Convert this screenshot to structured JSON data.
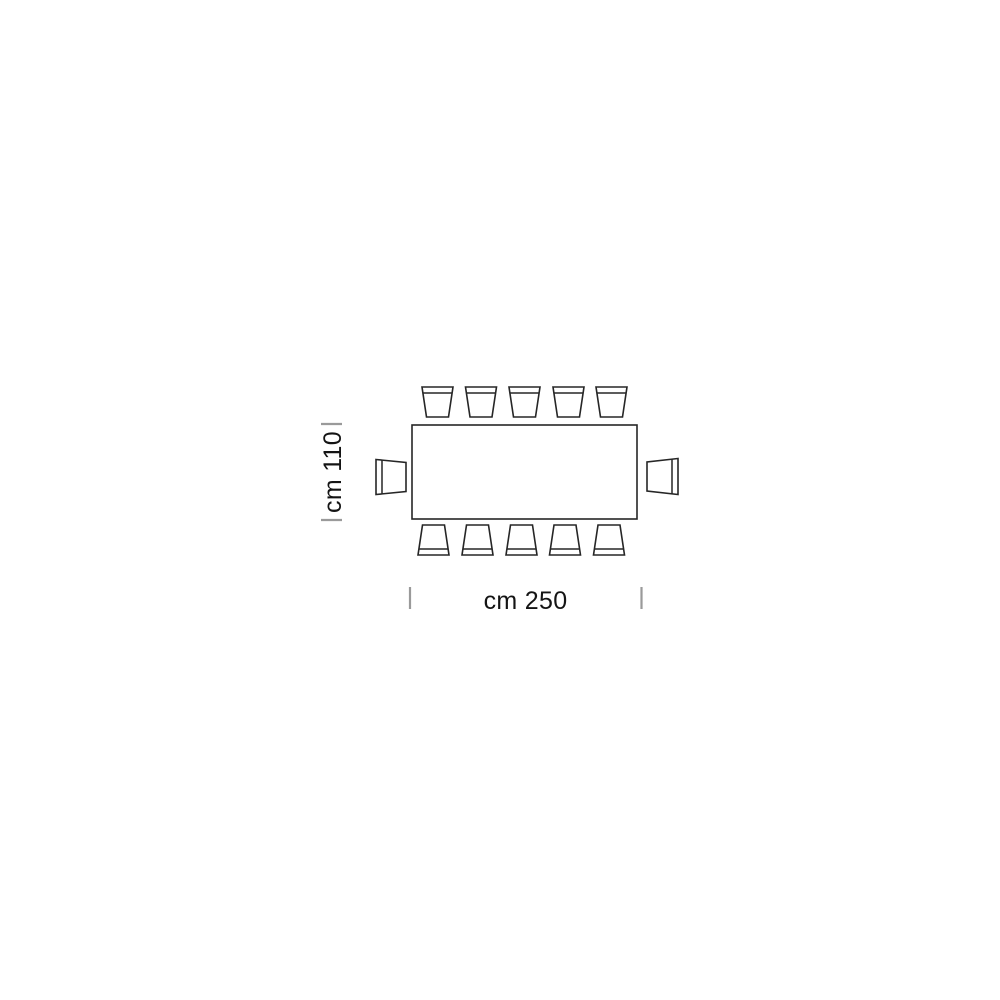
{
  "diagram": {
    "type": "furniture-plan-top-view",
    "description": "Top view plan of rectangular dining table seating 12 chairs",
    "stroke_color": "#262626",
    "tick_color": "#9a9a9a",
    "text_color": "#141414",
    "background": "#ffffff",
    "seats_total": 12,
    "table": {
      "shape": "rectangle",
      "x": 412,
      "y": 425,
      "width": 225,
      "height": 94
    },
    "chairs": {
      "back_width": 31,
      "front_width": 22,
      "depth": 30,
      "backrest_inset": 6,
      "top_row": {
        "edge_y": 387,
        "centers_x": [
          437.5,
          481,
          524.5,
          568.5,
          611.5
        ]
      },
      "bottom_row": {
        "edge_y": 525,
        "centers_x": [
          433.5,
          477.5,
          521.5,
          565,
          609
        ]
      },
      "left_end": {
        "edge_x": 376,
        "center_y": 477,
        "back_height": 35,
        "front_height": 29,
        "depth": 30
      },
      "right_end": {
        "edge_x": 678,
        "center_y": 476.5,
        "back_height": 36,
        "front_height": 29,
        "depth": 31
      }
    }
  },
  "dimensions": {
    "height": {
      "label": "cm 110",
      "value_cm": 110,
      "tick_x1": 321,
      "tick_x2": 342,
      "tick_y_top": 424,
      "tick_y_bottom": 520,
      "label_x": 341,
      "label_y": 472
    },
    "width": {
      "label": "cm 250",
      "value_cm": 250,
      "tick_x_left": 410,
      "tick_x_right": 641.5,
      "tick_y1": 587,
      "tick_y2": 609,
      "label_x": 525.5,
      "label_y": 609
    }
  }
}
